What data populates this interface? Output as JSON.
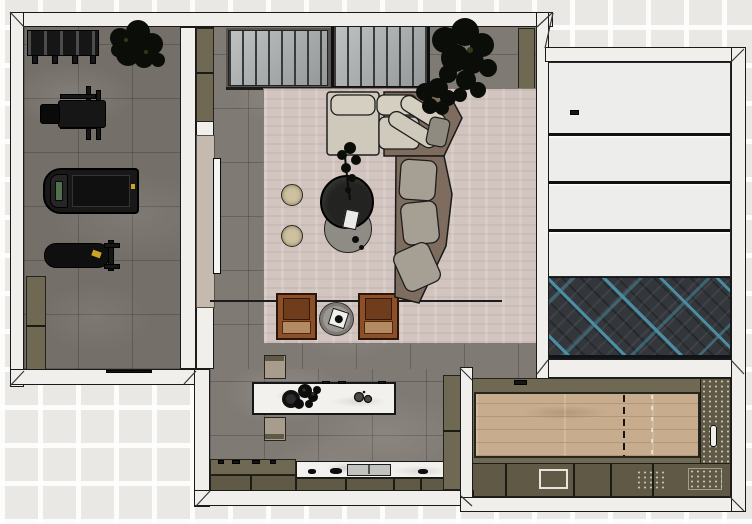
{
  "document": {
    "type": "interior floor plan render",
    "view": "top-down",
    "visible_text": "",
    "rooms": [
      {
        "name": "home-gym",
        "floor": "grey stone tile"
      },
      {
        "name": "living-room",
        "floor": "grey stone tile with large rug"
      },
      {
        "name": "kitchen",
        "floor": "grey stone tile"
      },
      {
        "name": "banded-door-room",
        "floor": "dark herringbone with teal accents"
      },
      {
        "name": "game-lane-room",
        "floor": "light wood lane with dashed centerline"
      }
    ],
    "furniture": [
      "dumbbell-rack",
      "gym-plant",
      "weight-machine",
      "treadmill",
      "workout-bench",
      "storage-cabinets",
      "slat-wall-panels",
      "media-wall",
      "tv-panel",
      "area-rug",
      "sectional-sofa",
      "round-poufs",
      "coffee-table-set",
      "decor-plant",
      "leather-armchairs",
      "side-table",
      "kitchen-island",
      "island-stools",
      "kitchen-counter",
      "sink",
      "tall-cabinet",
      "wood-lane",
      "sideboard-cabinets",
      "herringbone-floor",
      "banded-panels"
    ]
  },
  "colors": {
    "bg": "#e9e8e5",
    "wall": "#f0efec",
    "line": "#1a1a1a",
    "floor": "#807a74",
    "rug": "#d2c5c0",
    "olive": "#6f6853",
    "olive_dark": "#5f5946",
    "beige": "#c4bab0",
    "wood": "#c7ad8e",
    "marble": "#f2f1ed",
    "herring_base": "#33373b",
    "herring_teal": "#4b8ea3",
    "sofa_brown": "#7e6d5f",
    "cushion_cream": "#d5cfc2",
    "cushion_gray": "#a6a094",
    "leather": "#8d4f28",
    "leather_dark": "#6f3c1c",
    "seat_tex": "#b48a63",
    "pouf": "#cdc1a0",
    "screen_green": "#50704f",
    "accent_yellow": "#c9a227",
    "table_dark": "#232322",
    "table_gray": "#8f8c86",
    "stool": "#a89d8c"
  }
}
